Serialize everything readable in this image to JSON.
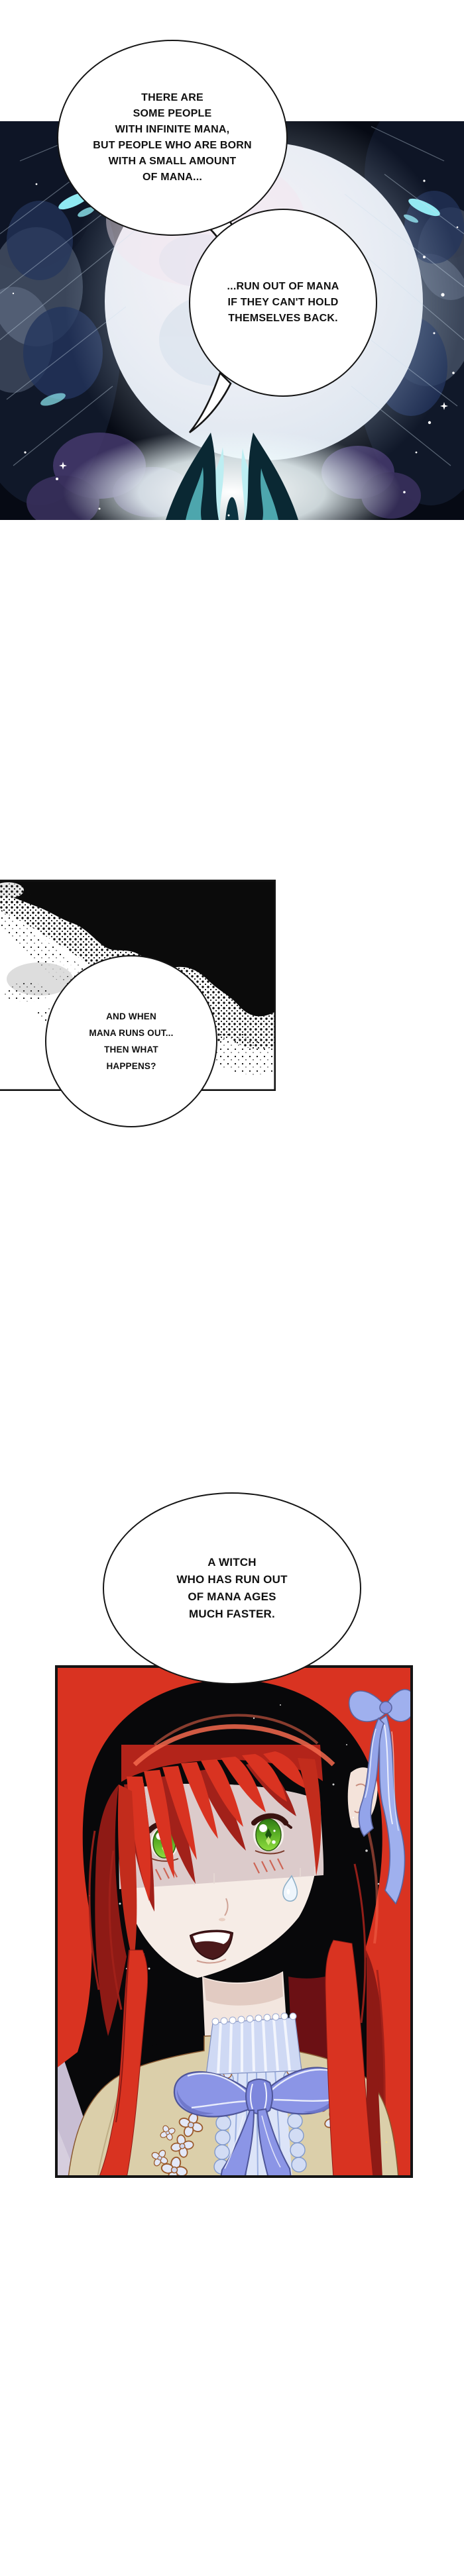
{
  "page": {
    "kind": "comic-page"
  },
  "speech_bubbles": {
    "b1": {
      "lines": [
        "THERE ARE",
        "SOME PEOPLE",
        "WITH INFINITE MANA,",
        "BUT PEOPLE WHO ARE BORN",
        "WITH A SMALL AMOUNT",
        "OF MANA..."
      ]
    },
    "b2": {
      "lines": [
        "...RUN OUT OF MANA",
        "IF THEY CAN'T HOLD",
        "THEMSELVES BACK."
      ]
    },
    "b3": {
      "lines": [
        "AND WHEN",
        "MANA RUNS OUT...",
        "THEN WHAT",
        "HAPPENS?"
      ]
    },
    "b4": {
      "lines": [
        "A WITCH",
        "WHO HAS RUN OUT",
        "OF MANA AGES",
        "MUCH FASTER."
      ]
    }
  },
  "colors": {
    "page_background": "#ffffff",
    "night_panel_background": "#060a14",
    "moon_pale": "#e9edf4",
    "magic_cyan": "#8fe9f2",
    "nebula_purple": "#453a6d",
    "smoke_black": "#0b0b0b",
    "hair_red": "#d93321",
    "hair_shadow": "#8e1a15",
    "eye_green": "#6fc92e",
    "skin": "#f6ece6",
    "face_shadow": "#dccbcb",
    "bow_periwinkle": "#8b95e6",
    "collar_blue": "#cfd9f4",
    "dress_tan": "#dbcfaa",
    "lace_outline_brown": "#9a5a2c",
    "wall_lavender": "#c8bed3",
    "bubble_border": "#151515"
  }
}
